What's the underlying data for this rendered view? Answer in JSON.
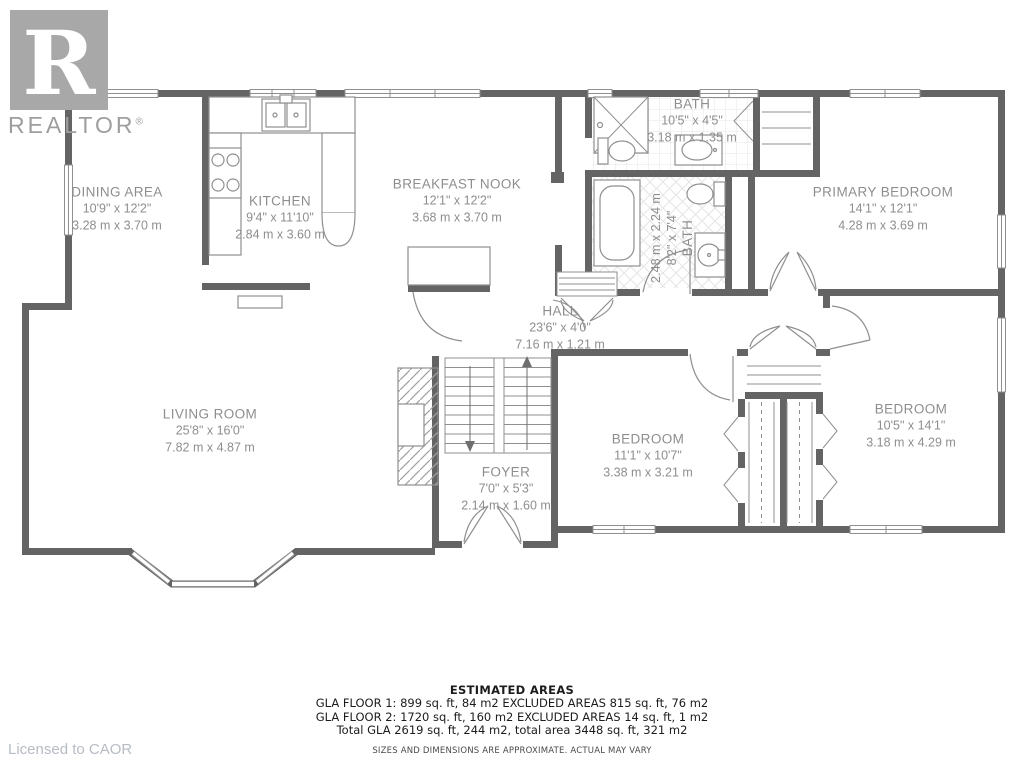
{
  "branding": {
    "logo_letter": "R",
    "logo_wordmark": "REALTOR",
    "logo_registered": "®",
    "licensed_to": "Licensed to CAOR"
  },
  "rooms": [
    {
      "name": "DINING AREA",
      "imperial": "10'9\" x 12'2\"",
      "metric": "3.28 m x 3.70 m"
    },
    {
      "name": "KITCHEN",
      "imperial": "9'4\" x 11'10\"",
      "metric": "2.84 m x 3.60 m"
    },
    {
      "name": "BREAKFAST NOOK",
      "imperial": "12'1\" x 12'2\"",
      "metric": "3.68 m x 3.70 m"
    },
    {
      "name": "BATH",
      "imperial": "10'5\" x 4'5\"",
      "metric": "3.18 m x 1.35 m"
    },
    {
      "name": "PRIMARY BEDROOM",
      "imperial": "14'1\" x 12'1\"",
      "metric": "4.28 m x 3.69 m"
    },
    {
      "name": "BATH",
      "imperial": "8'2\" x 7'4\"",
      "metric": "2.48 m x 2.24 m"
    },
    {
      "name": "HALL",
      "imperial": "23'6\" x 4'0\"",
      "metric": "7.16 m x 1.21 m"
    },
    {
      "name": "LIVING ROOM",
      "imperial": "25'8\" x 16'0\"",
      "metric": "7.82 m x 4.87 m"
    },
    {
      "name": "FOYER",
      "imperial": "7'0\" x 5'3\"",
      "metric": "2.14 m x 1.60 m"
    },
    {
      "name": "BEDROOM",
      "imperial": "11'1\" x 10'7\"",
      "metric": "3.38 m x 3.21 m"
    },
    {
      "name": "BEDROOM",
      "imperial": "10'5\" x 14'1\"",
      "metric": "3.18 m x 4.29 m"
    }
  ],
  "footer": {
    "title": "ESTIMATED AREAS",
    "line1": "GLA FLOOR 1: 899 sq. ft, 84 m2 EXCLUDED AREAS 815 sq. ft, 76 m2",
    "line2": "GLA FLOOR 2: 1720 sq. ft, 160 m2 EXCLUDED AREAS 14 sq. ft, 1 m2",
    "line3": "Total GLA 2619 sq. ft, 244 m2, total area 3448 sq. ft, 321 m2",
    "disclaimer": "SIZES AND DIMENSIONS ARE APPROXIMATE. ACTUAL MAY VARY"
  },
  "colors": {
    "wall": "#646464",
    "line": "#8f8f8f",
    "tile": "#e5e5e5",
    "label": "#8e8e8e"
  }
}
